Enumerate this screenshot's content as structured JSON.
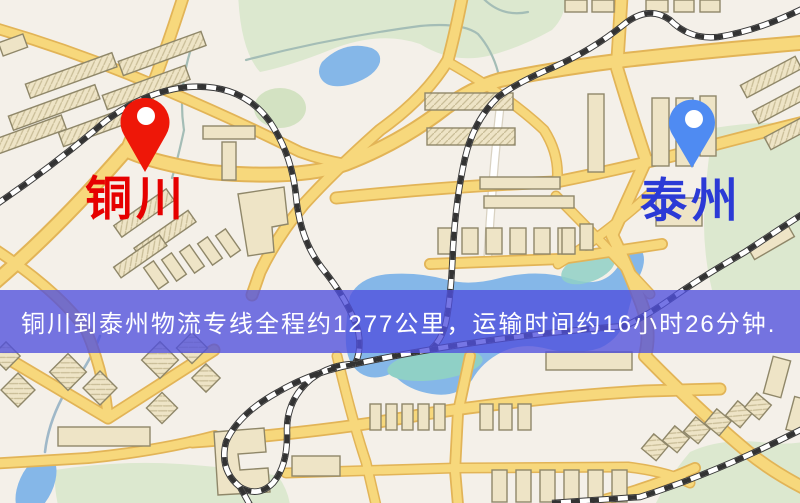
{
  "map": {
    "name": "logistics-route-map",
    "origin": {
      "label": "铜川",
      "marker_color": "#ee1708",
      "label_color": "#e60000"
    },
    "destination": {
      "label": "泰州",
      "marker_color": "#4f8bf2",
      "label_color": "#2b3ad6"
    },
    "banner": {
      "text": "铜川到泰州物流专线全程约1277公里，运输时间约16小时26分钟.",
      "distance_text": "约1277公里",
      "duration_text": "约16小时26分钟",
      "background": "#4f50de",
      "text_color": "#ffffff"
    },
    "palette": {
      "map_background": "#f4f0e9",
      "road": "#f7d87c",
      "road_casing": "#e2b457",
      "building": "#eee4c6",
      "park": "#dce8cf",
      "water": "#85b7e8",
      "water_teal": "#8fd0c6",
      "railway": "#333333"
    }
  }
}
